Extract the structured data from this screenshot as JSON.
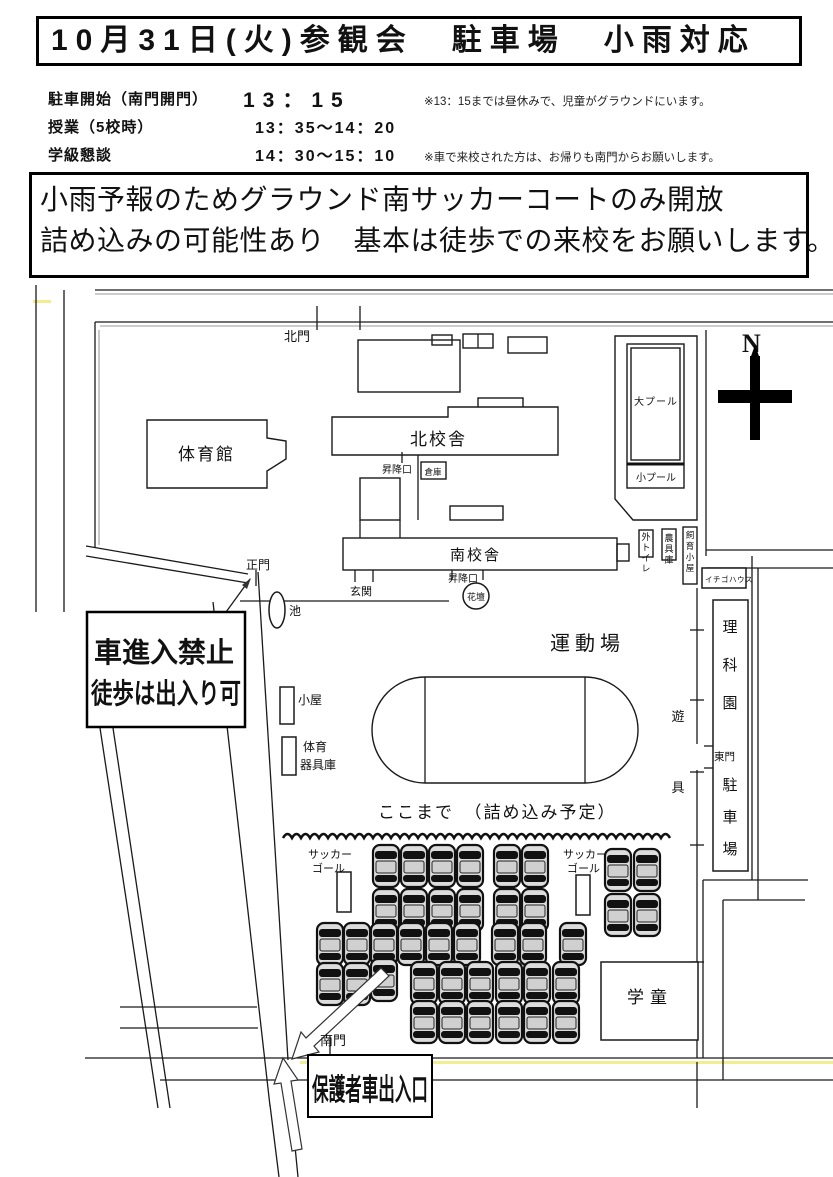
{
  "header": {
    "title": "10月31日(火)参観会　駐車場　小雨対応"
  },
  "schedule": {
    "rows": [
      {
        "label": "駐車開始（南門開門）",
        "time": "13：15",
        "note": "※13：15までは昼休みで、児童がグラウンドにいます。"
      },
      {
        "label": "授業（5校時）",
        "time": "13：35～14：20",
        "note": ""
      },
      {
        "label": "学級懇談",
        "time": "14：30～15：10",
        "note": "※車で来校された方は、お帰りも南門からお願いします。"
      }
    ]
  },
  "notice": {
    "line1": "小雨予報のためグラウンド南サッカーコートのみ開放",
    "line2": "詰め込みの可能性あり　基本は徒歩での来校をお願いします。"
  },
  "map": {
    "compass": "N",
    "labels": {
      "north_gate": "北門",
      "gym": "体育館",
      "north_building": "北校舎",
      "entrance_north": "昇降口",
      "storeroom": "倉庫",
      "large_pool": "大プール",
      "small_pool": "小プール",
      "outdoor_toilet": "外トイレ",
      "tool_shed": "農具庫",
      "animal_hut": "飼育小屋",
      "strawberry_house": "イチゴハウス",
      "main_gate": "正門",
      "pond": "池",
      "entrance_hall": "玄関",
      "south_building": "南校舎",
      "entrance_south": "昇降口",
      "flower_bed": "花壇",
      "sports_ground": "運動場",
      "hut": "小屋",
      "pe_storage_1": "体育",
      "pe_storage_2": "器具庫",
      "playground_equipment": "遊具",
      "science_garden": "理科園",
      "east_gate": "東門",
      "east_parking": "駐車場",
      "fill_limit": "ここまで　（詰め込み予定）",
      "soccer_goal_1": "サッカー",
      "soccer_goal_2": "ゴール",
      "south_gate": "南門",
      "afterschool": "学童",
      "parent_gate": "保護者車出入口"
    },
    "no_entry_sign": {
      "line1": "車進入禁止",
      "line2": "徒歩は出入り可"
    },
    "colors": {
      "road_yellow": "#f0ee8e"
    },
    "cars": [
      [
        386,
        866
      ],
      [
        414,
        866
      ],
      [
        442,
        866
      ],
      [
        470,
        866
      ],
      [
        507,
        866
      ],
      [
        535,
        866
      ],
      [
        386,
        910
      ],
      [
        414,
        910
      ],
      [
        442,
        910
      ],
      [
        470,
        910
      ],
      [
        507,
        910
      ],
      [
        535,
        910
      ],
      [
        330,
        944
      ],
      [
        357,
        944
      ],
      [
        384,
        944
      ],
      [
        411,
        944
      ],
      [
        439,
        944
      ],
      [
        467,
        944
      ],
      [
        505,
        944
      ],
      [
        533,
        944
      ],
      [
        573,
        944
      ],
      [
        330,
        984
      ],
      [
        357,
        984
      ],
      [
        384,
        980
      ],
      [
        424,
        983
      ],
      [
        452,
        983
      ],
      [
        480,
        983
      ],
      [
        509,
        983
      ],
      [
        537,
        983
      ],
      [
        566,
        983
      ],
      [
        424,
        1022
      ],
      [
        452,
        1022
      ],
      [
        480,
        1022
      ],
      [
        509,
        1022
      ],
      [
        537,
        1022
      ],
      [
        566,
        1022
      ],
      [
        618,
        870
      ],
      [
        647,
        870
      ],
      [
        618,
        915
      ],
      [
        647,
        915
      ]
    ]
  }
}
